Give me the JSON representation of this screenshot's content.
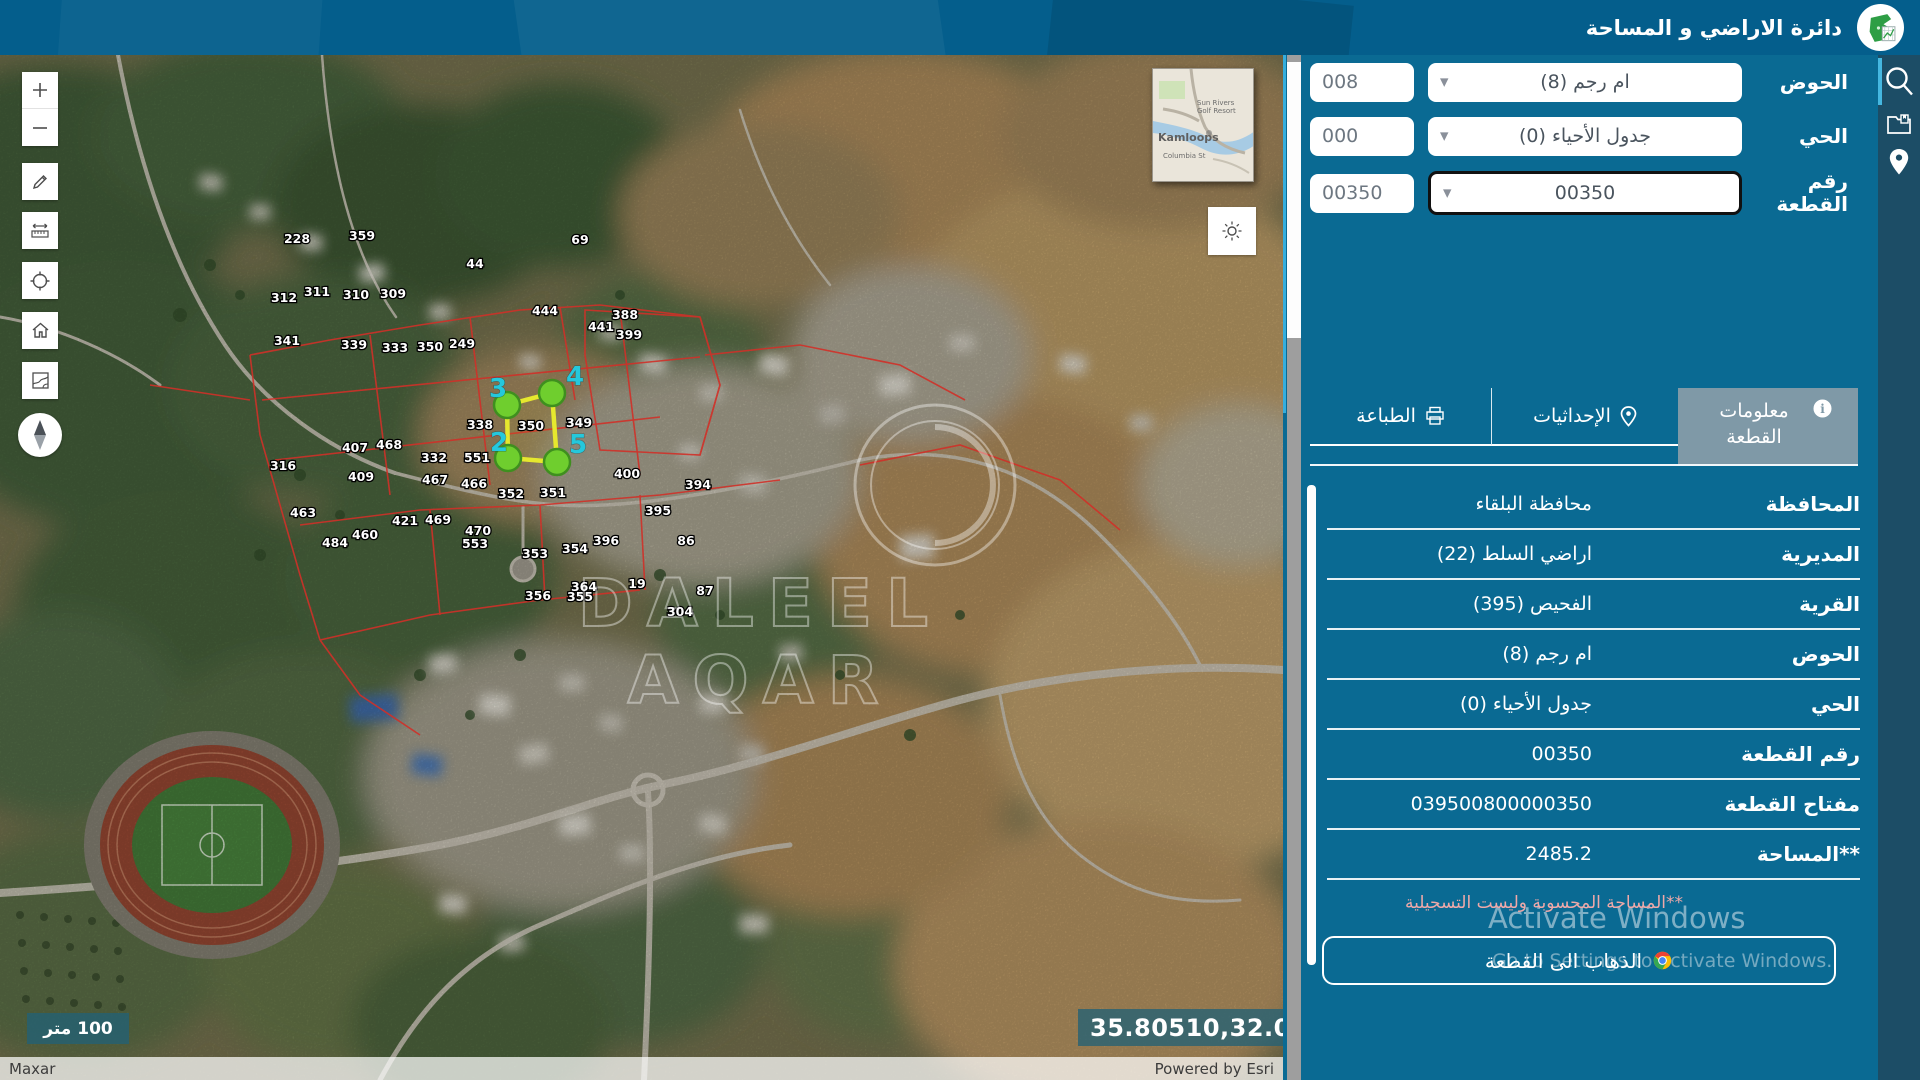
{
  "header": {
    "title": "دائرة الاراضي و المساحة"
  },
  "rail": {
    "icons": [
      {
        "name": "search",
        "active": true
      },
      {
        "name": "documents",
        "active": false
      },
      {
        "name": "location",
        "active": false
      }
    ]
  },
  "search_form": {
    "fields": [
      {
        "label": "الحوض",
        "selected": "ام رجم (8)",
        "code": "008",
        "focused": false
      },
      {
        "label": "الحي",
        "selected": "جدول الأحياء (0)",
        "code": "000",
        "focused": false
      },
      {
        "label": "رقم القطعة",
        "selected": "00350",
        "code": "00350",
        "focused": true
      }
    ]
  },
  "tabs": [
    {
      "label": "معلومات القطعة",
      "icon": "info-icon",
      "active": true
    },
    {
      "label": "الإحداثيات",
      "icon": "pin-icon",
      "active": false
    },
    {
      "label": "الطباعة",
      "icon": "printer-icon",
      "active": false
    }
  ],
  "parcel_info": {
    "rows": [
      {
        "label": "المحافظة",
        "value": "محافظة البلقاء"
      },
      {
        "label": "المديرية",
        "value": "اراضي السلط (22)"
      },
      {
        "label": "القرية",
        "value": "الفحيص (395)"
      },
      {
        "label": "الحوض",
        "value": "ام رجم (8)"
      },
      {
        "label": "الحي",
        "value": "جدول الأحياء (0)"
      },
      {
        "label": "رقم القطعة",
        "value": "00350"
      },
      {
        "label": "مفتاح القطعة",
        "value": "039500800000350"
      },
      {
        "label": "**المساحة",
        "value": "2485.2"
      }
    ],
    "footnote": "**المساحة المحسوبة وليست التسجيلية",
    "go_button": "الذهاب الى القطعة"
  },
  "activation": {
    "line1": "Activate Windows",
    "line2": "Go to Settings to activate Windows."
  },
  "map": {
    "scale_bar": "100 متر",
    "coordinates": "35.80510,32.00468",
    "attribution": {
      "left": "Maxar",
      "right": "Powered by Esri"
    },
    "watermark": "DALEEL AQAR",
    "inset": {
      "place": "Kamloops",
      "street": "Columbia St",
      "poi": "Sun Rivers Golf Resort"
    },
    "selected_parcel": {
      "polygon": [
        [
          507,
          350
        ],
        [
          552,
          338
        ],
        [
          557,
          407
        ],
        [
          508,
          403
        ]
      ],
      "vertices": [
        {
          "n": "3",
          "x": 489,
          "y": 342
        },
        {
          "n": "4",
          "x": 566,
          "y": 330
        },
        {
          "n": "2",
          "x": 490,
          "y": 396
        },
        {
          "n": "5",
          "x": 569,
          "y": 398
        }
      ]
    },
    "parcel_labels": [
      {
        "t": "228",
        "x": 297,
        "y": 188
      },
      {
        "t": "359",
        "x": 362,
        "y": 185
      },
      {
        "t": "312",
        "x": 284,
        "y": 247
      },
      {
        "t": "311",
        "x": 317,
        "y": 241
      },
      {
        "t": "310",
        "x": 356,
        "y": 244
      },
      {
        "t": "309",
        "x": 393,
        "y": 243
      },
      {
        "t": "69",
        "x": 580,
        "y": 189
      },
      {
        "t": "44",
        "x": 475,
        "y": 213
      },
      {
        "t": "444",
        "x": 545,
        "y": 260
      },
      {
        "t": "388",
        "x": 625,
        "y": 264
      },
      {
        "t": "441",
        "x": 601,
        "y": 276
      },
      {
        "t": "399",
        "x": 629,
        "y": 284
      },
      {
        "t": "341",
        "x": 287,
        "y": 290
      },
      {
        "t": "339",
        "x": 354,
        "y": 294
      },
      {
        "t": "333",
        "x": 395,
        "y": 297
      },
      {
        "t": "350",
        "x": 430,
        "y": 296
      },
      {
        "t": "249",
        "x": 462,
        "y": 293
      },
      {
        "t": "338",
        "x": 480,
        "y": 374
      },
      {
        "t": "350",
        "x": 531,
        "y": 375
      },
      {
        "t": "349",
        "x": 579,
        "y": 372
      },
      {
        "t": "400",
        "x": 627,
        "y": 423
      },
      {
        "t": "394",
        "x": 698,
        "y": 434
      },
      {
        "t": "352",
        "x": 511,
        "y": 443
      },
      {
        "t": "351",
        "x": 553,
        "y": 442
      },
      {
        "t": "466",
        "x": 474,
        "y": 433
      },
      {
        "t": "467",
        "x": 435,
        "y": 429
      },
      {
        "t": "469",
        "x": 438,
        "y": 469
      },
      {
        "t": "470",
        "x": 478,
        "y": 480
      },
      {
        "t": "395",
        "x": 658,
        "y": 460
      },
      {
        "t": "396",
        "x": 606,
        "y": 490
      },
      {
        "t": "86",
        "x": 686,
        "y": 490
      },
      {
        "t": "353",
        "x": 535,
        "y": 503
      },
      {
        "t": "354",
        "x": 575,
        "y": 498
      },
      {
        "t": "356",
        "x": 538,
        "y": 545
      },
      {
        "t": "355",
        "x": 580,
        "y": 546
      },
      {
        "t": "87",
        "x": 705,
        "y": 540
      },
      {
        "t": "304",
        "x": 680,
        "y": 561
      },
      {
        "t": "19",
        "x": 637,
        "y": 533
      },
      {
        "t": "463",
        "x": 303,
        "y": 462
      },
      {
        "t": "316",
        "x": 283,
        "y": 415
      },
      {
        "t": "407",
        "x": 355,
        "y": 397
      },
      {
        "t": "468",
        "x": 389,
        "y": 394
      },
      {
        "t": "332",
        "x": 434,
        "y": 407
      },
      {
        "t": "551",
        "x": 477,
        "y": 407
      },
      {
        "t": "409",
        "x": 361,
        "y": 426
      },
      {
        "t": "421",
        "x": 405,
        "y": 470
      },
      {
        "t": "484",
        "x": 335,
        "y": 492
      },
      {
        "t": "460",
        "x": 365,
        "y": 484
      },
      {
        "t": "553",
        "x": 475,
        "y": 493
      },
      {
        "t": "364",
        "x": 584,
        "y": 536
      }
    ]
  },
  "colors": {
    "panel": "#0a6a93",
    "header": "#045e8c",
    "rail": "#1c4d66",
    "accent": "#35aede",
    "active_tab": "#7f99a7",
    "footnote": "#efa9a9",
    "parcel_line": "#e6e82e",
    "vertex_fill": "#6fce2e",
    "vertex_label": "#25c8dc",
    "cadastral": "#d03028"
  }
}
